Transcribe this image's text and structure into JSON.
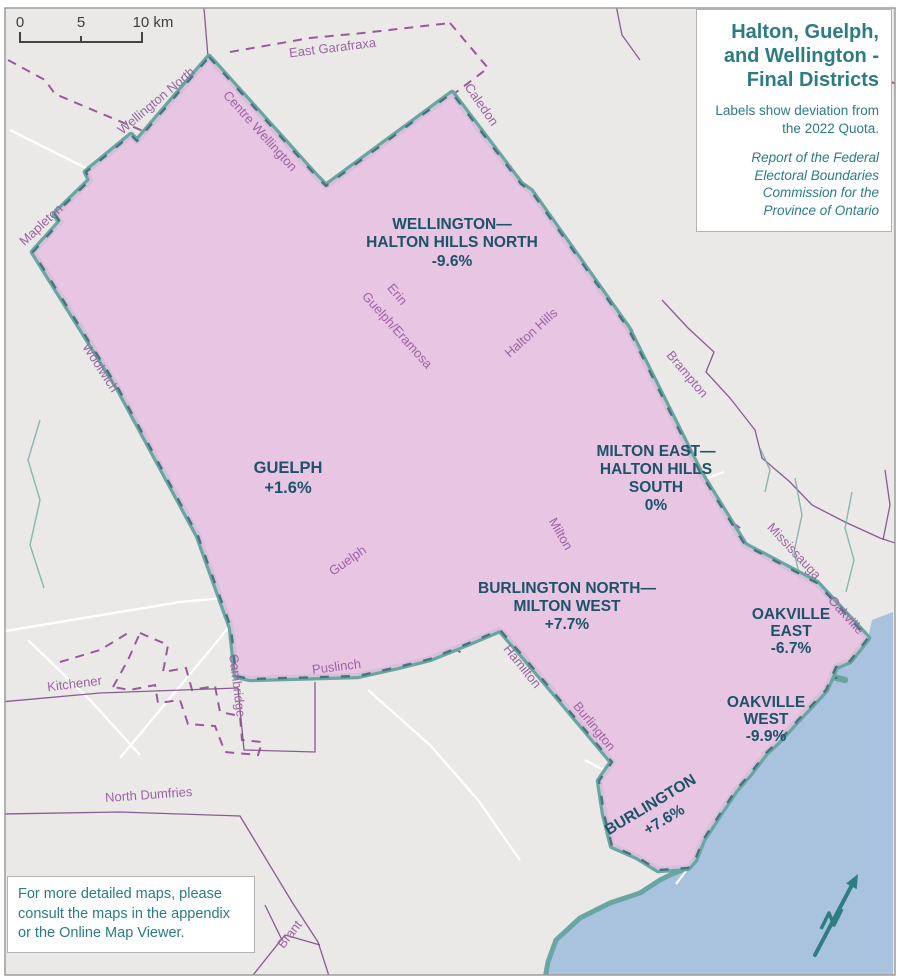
{
  "map": {
    "title_box": {
      "title": "Halton, Guelph, and Wellington - Final Districts",
      "subtitle": "Labels show deviation from the 2022 Quota.",
      "attribution": "Report of the Federal Electoral Boundaries Commission for the Province of Ontario"
    },
    "scale_bar": {
      "tick_start": "0",
      "tick_mid": "5",
      "tick_end": "10 km"
    },
    "note_box": {
      "text": "For more detailed maps, please consult the maps in the appendix or the Online Map Viewer."
    },
    "districts": [
      {
        "name": "Wellington—Halton Hills North",
        "label_lines": [
          "WELLINGTON—",
          "HALTON HILLS NORTH"
        ],
        "deviation": "-9.6%"
      },
      {
        "name": "Guelph",
        "label_lines": [
          "GUELPH"
        ],
        "deviation": "+1.6%"
      },
      {
        "name": "Milton East—Halton Hills South",
        "label_lines": [
          "MILTON EAST—",
          "HALTON HILLS",
          "SOUTH"
        ],
        "deviation": "0%"
      },
      {
        "name": "Burlington North—Milton West",
        "label_lines": [
          "BURLINGTON NORTH—",
          "MILTON WEST"
        ],
        "deviation": "+7.7%"
      },
      {
        "name": "Oakville East",
        "label_lines": [
          "OAKVILLE",
          "EAST"
        ],
        "deviation": "-6.7%"
      },
      {
        "name": "Oakville West",
        "label_lines": [
          "OAKVILLE",
          "WEST"
        ],
        "deviation": "-9.9%"
      },
      {
        "name": "Burlington",
        "label_lines": [
          "BURLINGTON"
        ],
        "deviation": "+7.6%"
      }
    ],
    "municipalities": [
      "East Garafraxa",
      "Wellington North",
      "Centre Wellington",
      "Mapleton",
      "Caledon",
      "Woolwich",
      "Erin",
      "Guelph/Eramosa",
      "Halton Hills",
      "Brampton",
      "Milton",
      "Mississauga",
      "Oakville",
      "Guelph",
      "Hamilton",
      "Burlington",
      "Puslinch",
      "Cambridge",
      "Kitchener",
      "North Dumfries",
      "Brant"
    ],
    "north_arrow": "N",
    "colors": {
      "district_fill": "#e8c5e3",
      "guelph_fill": "#f1d9ee",
      "district_border": "#6aa6a1",
      "border_dash_overlay": "#44697a",
      "municipal_boundary": "#8e4b90",
      "municipal_label": "#9c63a2",
      "district_label": "#1c5366",
      "heading_text": "#2b7c83",
      "lake": "#a9c3de",
      "land": "#eae9e7"
    }
  }
}
